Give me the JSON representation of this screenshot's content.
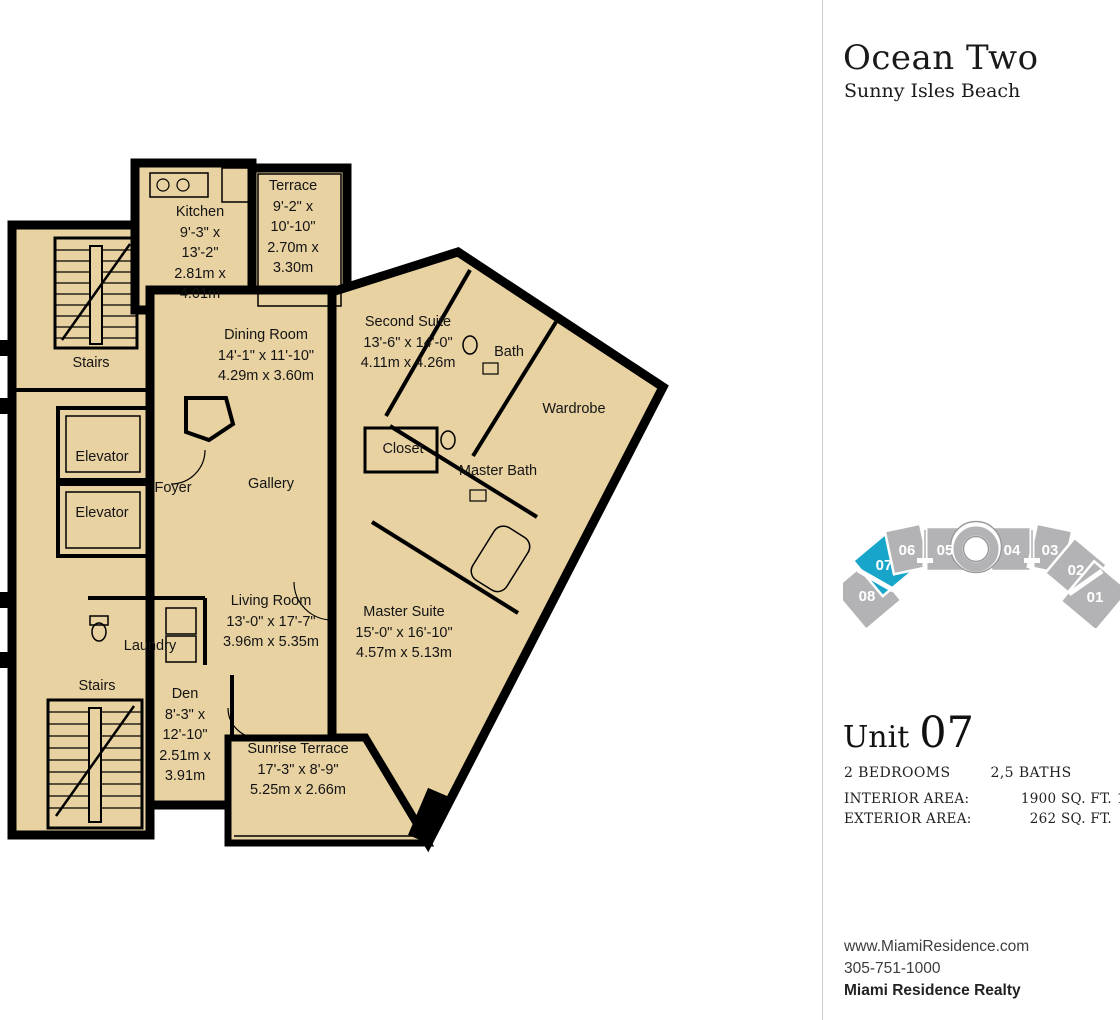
{
  "header": {
    "title": "Ocean Two",
    "subtitle": "Sunny Isles Beach"
  },
  "plan": {
    "rooms": [
      {
        "name": "kitchen",
        "label": "Kitchen\n9'-3\" x\n13'-2\"\n2.81m x\n4.01m"
      },
      {
        "name": "terrace",
        "label": "Terrace\n9'-2\" x\n10'-10\"\n2.70m x\n3.30m"
      },
      {
        "name": "dining-room",
        "label": "Dining Room\n14'-1\" x 11'-10\"\n4.29m x 3.60m"
      },
      {
        "name": "second-suite",
        "label": "Second Suite\n13'-6\" x 14'-0\"\n4.11m x 4.26m"
      },
      {
        "name": "bath",
        "label": "Bath"
      },
      {
        "name": "wardrobe",
        "label": "Wardrobe"
      },
      {
        "name": "closet",
        "label": "Closet"
      },
      {
        "name": "master-bath",
        "label": "Master Bath"
      },
      {
        "name": "stairs-top",
        "label": "Stairs"
      },
      {
        "name": "elevator-1",
        "label": "Elevator"
      },
      {
        "name": "elevator-2",
        "label": "Elevator"
      },
      {
        "name": "foyer",
        "label": "Foyer"
      },
      {
        "name": "gallery",
        "label": "Gallery"
      },
      {
        "name": "living-room",
        "label": "Living Room\n13'-0\" x 17'-7\"\n3.96m x 5.35m"
      },
      {
        "name": "master-suite",
        "label": "Master Suite\n15'-0\" x 16'-10\"\n4.57m x 5.13m"
      },
      {
        "name": "laundry",
        "label": "Laundry"
      },
      {
        "name": "stairs-bottom",
        "label": "Stairs"
      },
      {
        "name": "den",
        "label": "Den\n8'-3\" x\n12'-10\"\n2.51m x\n3.91m"
      },
      {
        "name": "sunrise-terrace",
        "label": "Sunrise Terrace\n17'-3\" x 8'-9\"\n5.25m x 2.66m"
      }
    ]
  },
  "minimap": {
    "highlighted_unit": "07",
    "units": [
      {
        "label": "01"
      },
      {
        "label": "02"
      },
      {
        "label": "03"
      },
      {
        "label": "04"
      },
      {
        "label": "05"
      },
      {
        "label": "06"
      },
      {
        "label": "07"
      },
      {
        "label": "08"
      }
    ]
  },
  "unit_info": {
    "unit_word": "Unit",
    "unit_number": "07",
    "bedrooms": "2 BEDROOMS",
    "baths": "2,5 BATHS",
    "rows": [
      {
        "label": "INTERIOR AREA:",
        "sqft": "1900 SQ. FT.",
        "m2": "177 M²"
      },
      {
        "label": "EXTERIOR AREA:",
        "sqft": "262 SQ. FT.",
        "m2": "24 M²"
      }
    ]
  },
  "contact": {
    "website": "www.MiamiResidence.com",
    "phone": "305-751-1000",
    "company": "Miami Residence Realty"
  },
  "colors": {
    "accent_teal": "#17a5c9",
    "plan_fill": "#e8d2a2",
    "wall_black": "#000000",
    "unit_gray": "#b3b3b6"
  }
}
